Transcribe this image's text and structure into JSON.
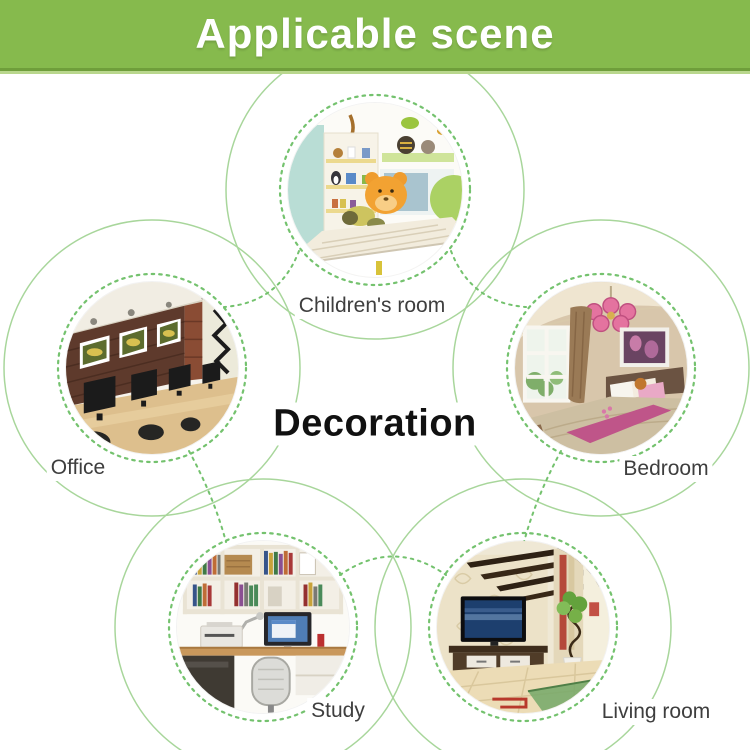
{
  "banner": {
    "title": "Applicable scene"
  },
  "center_title": "Decoration",
  "scenes": [
    {
      "id": "children-room",
      "label": "Children's room",
      "photo_desc": "white kids bed with orange bear plush, toy shelves, teal wall"
    },
    {
      "id": "office",
      "label": "Office",
      "photo_desc": "dark brick wall with three framed pictures, wooden desks with black monitors"
    },
    {
      "id": "bedroom",
      "label": "Bedroom",
      "photo_desc": "beige bedroom, pink chandelier, window, bed with pink pillows and runner"
    },
    {
      "id": "study",
      "label": "Study",
      "photo_desc": "white bookshelves full of books, desk with monitor, printer and chair"
    },
    {
      "id": "living-room",
      "label": "Living room",
      "photo_desc": "flat TV on dark stand, patterned wall, dark ceiling slats, plant"
    }
  ],
  "colors": {
    "banner_green": "#86ba4d",
    "banner_edge_dark": "#6f9e3b",
    "banner_edge_light": "#b9d78d",
    "ring_green": "#74c26e",
    "arc_green": "#a8d69b",
    "label_gray": "#3e3e3e",
    "title_black": "#111111"
  }
}
